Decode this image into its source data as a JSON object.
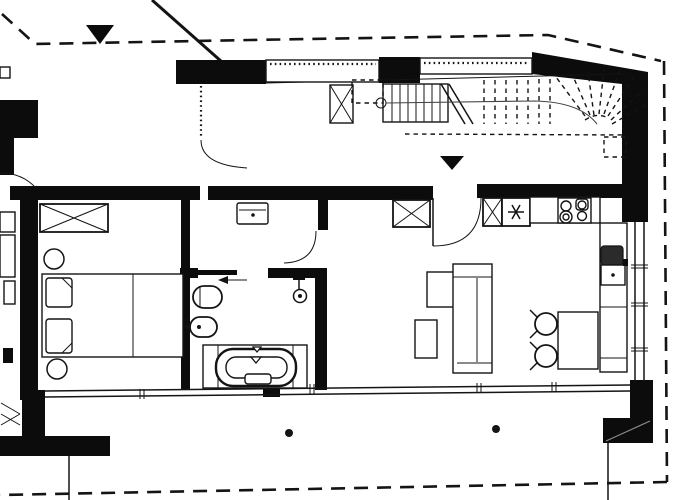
{
  "meta": {
    "title": "Apartment floor plan",
    "drawing_type": "black-and-white architectural floor plan, plan view",
    "paper_color": "#ffffff",
    "ink_color": "#141414",
    "no_visible_text": true
  },
  "labels": {
    "plan": "Apartment floor plan",
    "boundary": "Dashed roof / plot outline",
    "section_marker_top": "Section marker triangle (top left)",
    "entry_marker": "Entrance marker triangle above door",
    "staircase": "Staircase with break line and dashed winder treads",
    "hall": "Entrance hall with wall-hung washbasin",
    "bedroom": "Bedroom with wardrobe, double bed, two pillows, two round stools",
    "bathroom": "Bathroom with sliding door, toilet, bidet, shower and bathtub",
    "living_kitchen": "Living room with open kitchen",
    "kitchen_run": "Kitchen run: tall cabinet, fridge-freezer, 4-burner cooktop, sink counter",
    "dining": "Dining table with two chairs",
    "sofa": "L-shaped corner sofa with coffee table",
    "terrace": "Terrace strip with two columns",
    "windows": "Glazed window bands (double lines with mullion ticks)"
  },
  "counts": {
    "section_triangles": 2,
    "column_dots": 2,
    "stair_solid_treads": 7,
    "stair_dashed_treads": 7,
    "stair_winder_treads": 8,
    "cooktop_burners": 4,
    "dining_chairs": 2,
    "bed_pillows": 2,
    "round_stools": 2,
    "x_crossed_cabinets": 4
  },
  "icons": {
    "snowflake_icon": "fridge-freezer symbol (asterisk)",
    "x_cross_icon": "crossed rectangle = wardrobe / tall cabinet / duct",
    "shower_icon": "hanging shower head with hose",
    "walking_line_icon": "stair walking line with start circle",
    "sliding_door_arrow_icon": "arrow showing sliding direction (left)",
    "triangle_marker_icon": "filled downward triangle"
  },
  "colors": {
    "wall_fill": "#0c0c0c",
    "sink_basin_fill": "#2b2b2b",
    "paper": "#ffffff"
  }
}
